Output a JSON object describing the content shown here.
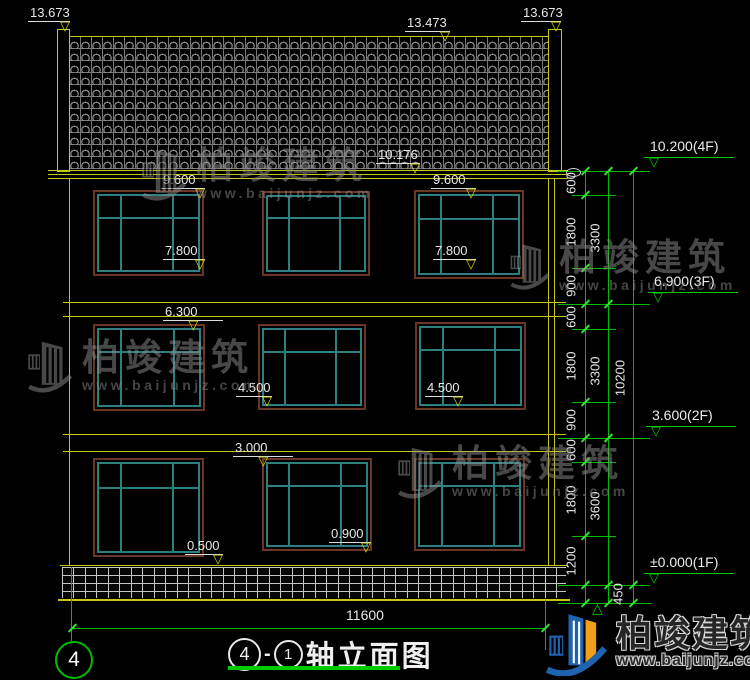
{
  "marks": [
    "13.673",
    "13.473",
    "13.673",
    "10.176",
    "9.600",
    "9.600",
    "7.800",
    "7.800",
    "6.300",
    "4.500",
    "4.500",
    "3.000",
    "0.500",
    "0.900"
  ],
  "floors": [
    "10.200(4F)",
    "6.900(3F)",
    "3.600(2F)",
    "±0.000(1F)"
  ],
  "segs": [
    "600",
    "1800",
    "900",
    "600",
    "1800",
    "900",
    "600",
    "1800",
    "1200"
  ],
  "chains": [
    "3300",
    "3300",
    "3600"
  ],
  "total_dim": "10200",
  "plinth_dim": "450",
  "width_dim": "11600",
  "title": {
    "axis_start": "4",
    "separator": "-",
    "axis_end": "1",
    "text": "轴立面图"
  },
  "axis_bubble": "4",
  "brand": {
    "name": "柏竣建筑",
    "site": "www.baijunjz.com"
  },
  "colors": {
    "background": "#000000",
    "cad_yellow": "#c6c616",
    "cad_green": "#00bb00",
    "cad_white": "#e8e8e8",
    "window_teal": "#2e8080",
    "window_brown": "#6b3626",
    "tile_gray": "#8f8f8f",
    "logo_blue": "#1f63b0",
    "logo_orange": "#f0a11a"
  }
}
